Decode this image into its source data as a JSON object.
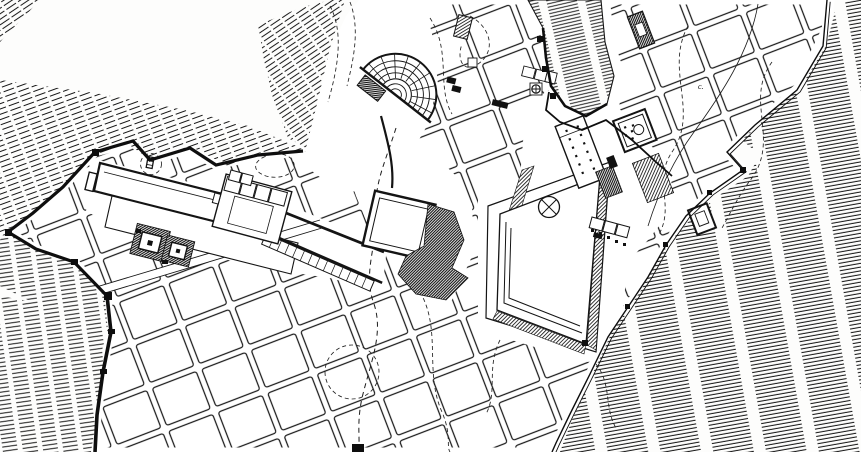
{
  "map": {
    "kind": "archaeological-city-plan",
    "style": "black-and-white ink line drawing, Hippodamian street grid with terrain hatching",
    "colors": {
      "ink": "#161616",
      "paper": "#fdfdfc"
    },
    "labels": [
      {
        "text": "c.",
        "x": 698,
        "y": 89
      }
    ],
    "features": [
      "terrain-hatching-northwest",
      "terrain-hatching-west",
      "terrain-hatching-southwest",
      "terrain-hatching-east",
      "acropolis-outcrop",
      "city-wall-west",
      "city-wall-east",
      "street-grid-blocks",
      "theater",
      "agora-plaza",
      "agora-stoas",
      "bouleuterion",
      "columned-hall",
      "quadrant-rotunda",
      "sanctuary-terrace",
      "temple-courts",
      "colonnade-stoa-row",
      "tilted-temenos-square",
      "terrace-hatch-mound",
      "gate-street",
      "dashed-contour-lines",
      "dashed-road"
    ]
  }
}
